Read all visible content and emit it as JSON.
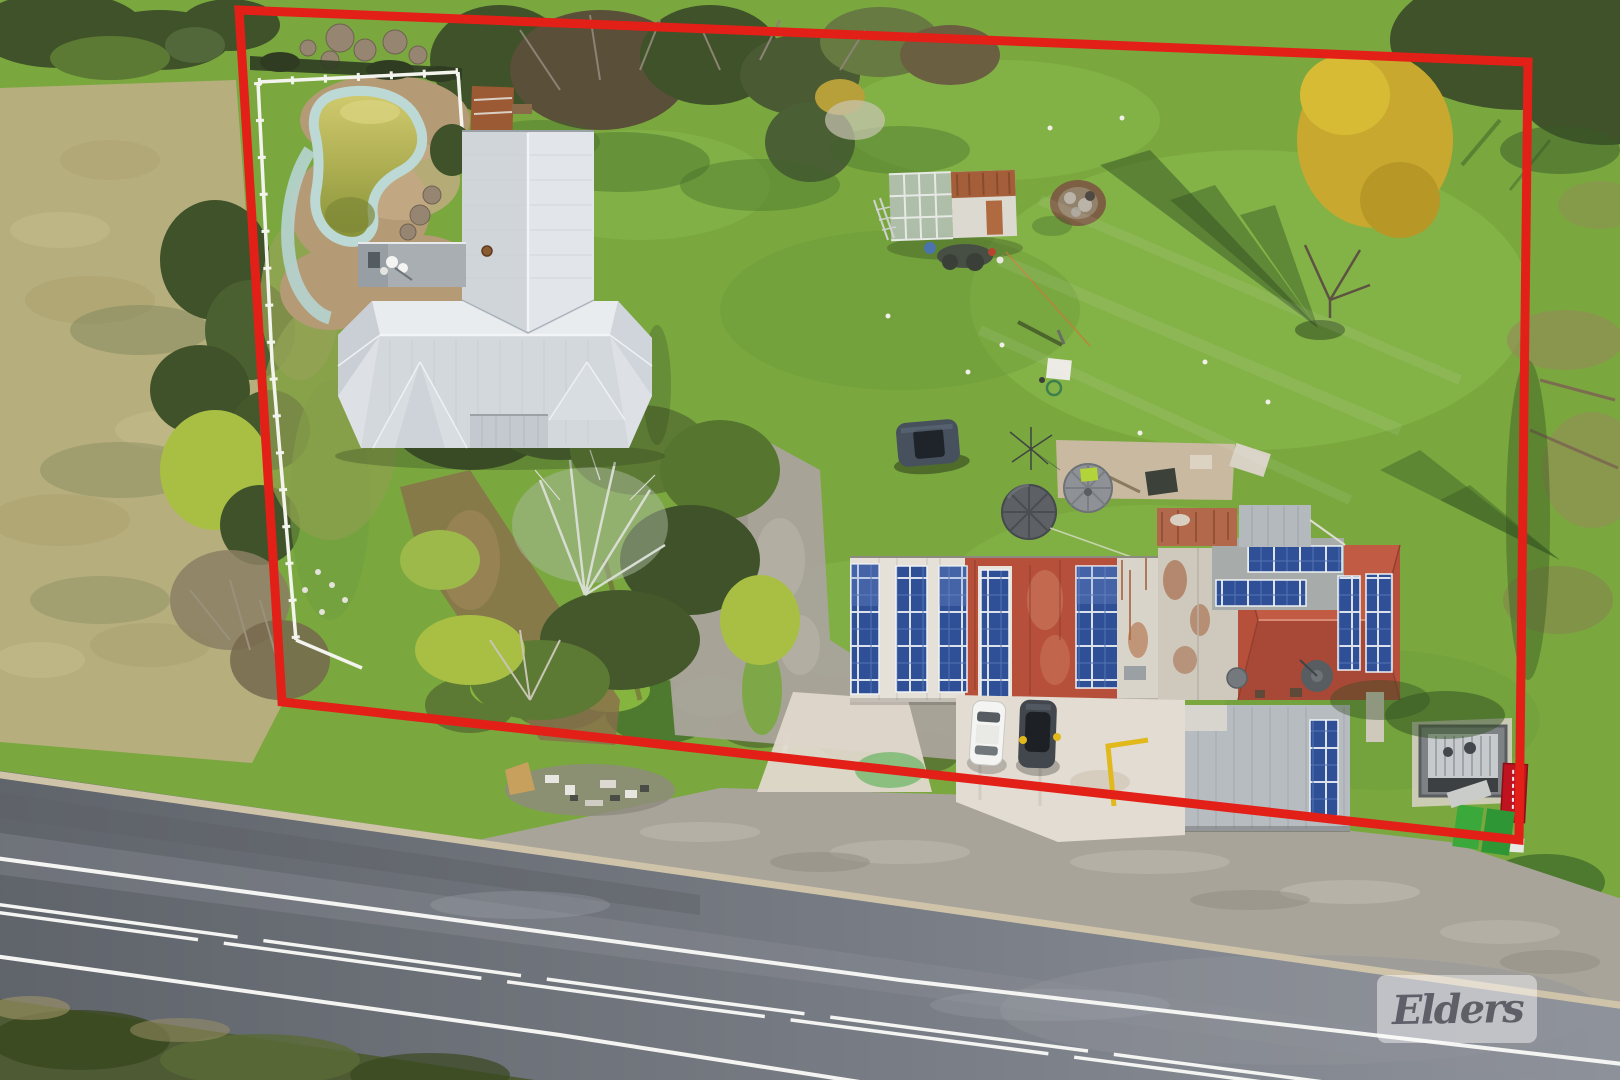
{
  "image": {
    "kind": "aerial drone photograph (real-estate listing)",
    "subject": "rural property with house, swimming pool, outbuildings with solar panels, gravel driveway and sealed road frontage",
    "width": 1620,
    "height": 1080
  },
  "watermark": {
    "label": "Elders"
  },
  "boundary": {
    "points": "239,10 1528,62 1519,840 282,702",
    "stroke_width": 9
  },
  "palette": {
    "red": "#e32017",
    "solar": "#2f4f97",
    "roofRed": "#b6503a",
    "grass": "#7aa83f",
    "grassLight": "#8fbf52",
    "grassDark": "#5d8a31",
    "dry": "#b7ae7d",
    "treeDark": "#3f5229",
    "treeMid": "#5c7a33",
    "treeYellow": "#a9bf44",
    "gold": "#c9a82f",
    "road": "#70747b",
    "gravel": "#a8a49a",
    "concrete": "#e0d8cc",
    "houseRoof": "#dde1e5",
    "poolWater": "#b3ae52",
    "poolEdge": "#bdd9d5",
    "dirt": "#b59a76",
    "lineWhite": "#f4f4f2",
    "wmText": "#44444e"
  },
  "features": [
    "red property boundary overlay",
    "Elders watermark",
    "two-lane sealed road with white edge and centre line markings",
    "gravel road shoulder and verge",
    "main house with light grey hipped metal roof and rooftop deck",
    "fenced yard with kidney-shaped swimming pool of green water",
    "greenhouse / shed with rusted corrugated roof",
    "commercial buildings with red roofs and blue rooftop solar arrays",
    "building wing with rust-streaked roof and satellite dishes",
    "grey corrugated outbuilding with solar panel column",
    "open storage shed",
    "two round water tanks and concrete pad",
    "white car and dark SUV parked on concrete apron",
    "dark hatchback parked on the lawn",
    "gravel driveway from road",
    "scrap junk pile on road verge",
    "dry grass paddock to the west",
    "lawns with long bare-tree shadows",
    "red roadside signboard"
  ]
}
